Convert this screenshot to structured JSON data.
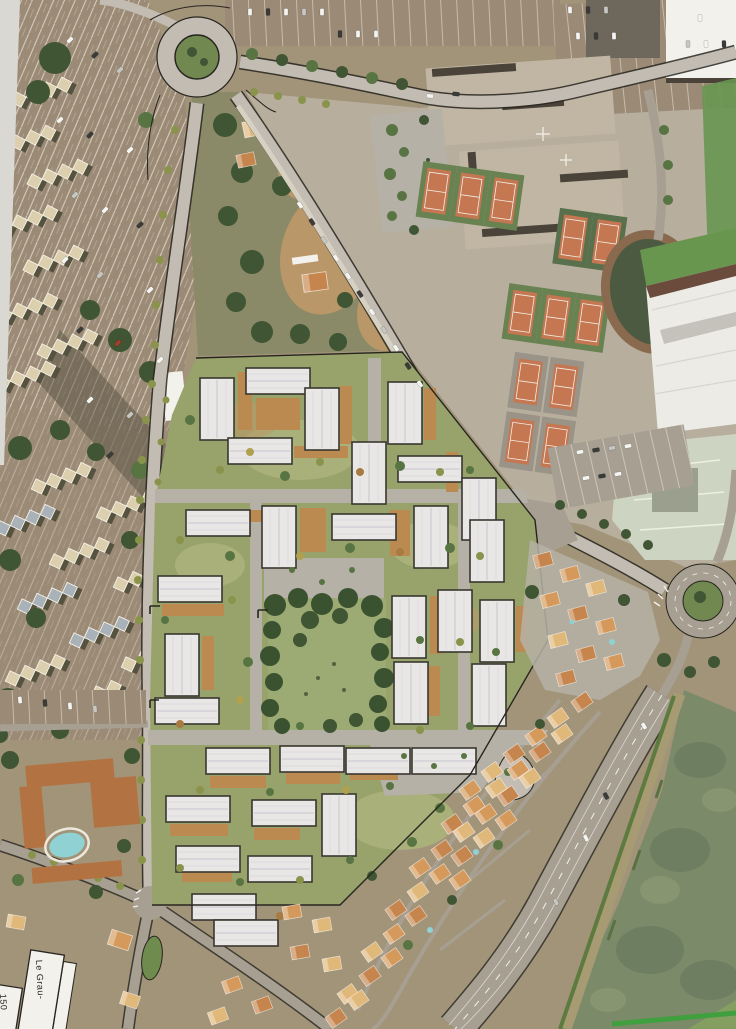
{
  "meta": {
    "description": "Photograph of an aerial masterplan: a proposed low-rise housing development (white gabled buildings, lawns, wooden decks, central pine grove) rendered over a satellite photo of a seaside town, surrounded by parking lots, apartment complexes, a school campus with tennis courts, two roundabouts, villa neighbourhoods and a green river."
  },
  "labels": {
    "parcel_main": "Le Grau-",
    "parcel_left": "150"
  },
  "features": [
    "left-parking",
    "apartment-blocks",
    "top-roundabout",
    "school-campus",
    "tennis-courts",
    "sports-hall",
    "sports-pitch",
    "brownfield-lot",
    "planned-development",
    "central-grove",
    "right-roundabout",
    "mid-right-houses",
    "south-residential",
    "riverside-road",
    "river",
    "hotel-pool-block",
    "crossroads",
    "parcel-labels"
  ],
  "palette": {
    "ground": "#a39478",
    "pageEdge": "#dbd9d4",
    "parkingAsphalt": "#9c8a74",
    "aptRoof": "#dcd0ac",
    "aptShadow": "#55523f",
    "aptBlue": "#a9b2ba",
    "treeDark": "#3e5531",
    "treeMid": "#567440",
    "treeOlive": "#8a9448",
    "treeYellow": "#b0a14b",
    "treeAuburn": "#a87a3f",
    "scrub": "#8b8a66",
    "dirt": "#bb9766",
    "sand": "#c9ab78",
    "roadPlan": "#c3bdb2",
    "roadAsphalt": "#a89f92",
    "white": "#f4f2ec",
    "ink": "#26241f",
    "campusBase": "#b8ae9e",
    "campusSlab": "#c2b7a3",
    "campusDark": "#6e675b",
    "roofStrip": "#4a4238",
    "courtOrange": "#c8764f",
    "courtGreen": "#68824f",
    "courtGreenDark": "#57704a",
    "courtGray": "#9a9488",
    "pitchGreen": "#67974c",
    "hallWhite": "#edece7",
    "hallShadow": "#6b4a3a",
    "flatPale": "#ced5c1",
    "track": "#8a6a4c",
    "grassPark": "#70894e",
    "devLawn": "#98a369",
    "devLawnLight": "#a9b177",
    "deckOchre": "#bd8a4d",
    "bldgRoof": "#eae8e6",
    "bldgRidge": "#c9c6cf",
    "bldgOutline": "#39362f",
    "plazaGray": "#b6b1a6",
    "pineDark": "#39522e",
    "meadow": "#9cab72",
    "houseRoofA": "#d89a58",
    "houseRoofB": "#c8854a",
    "houseRoofC": "#e3b877",
    "houseWall": "#e9ddc4",
    "hotelRoof": "#b5713f",
    "pool": "#8ed2d6",
    "riverWater": "#7b8a68",
    "riverDark": "#6d7e60",
    "riverLight": "#879570",
    "bank": "#a89b72",
    "bankVeg": "#5c7a3c",
    "greenLine": "#3da03a",
    "islandGreen": "#6f8c4b",
    "quay": "#b5ab8e",
    "carWhite": "#f5f5f2",
    "carDark": "#3a3a38",
    "carSilver": "#c7c7c3",
    "carRed": "#a63c2c"
  }
}
